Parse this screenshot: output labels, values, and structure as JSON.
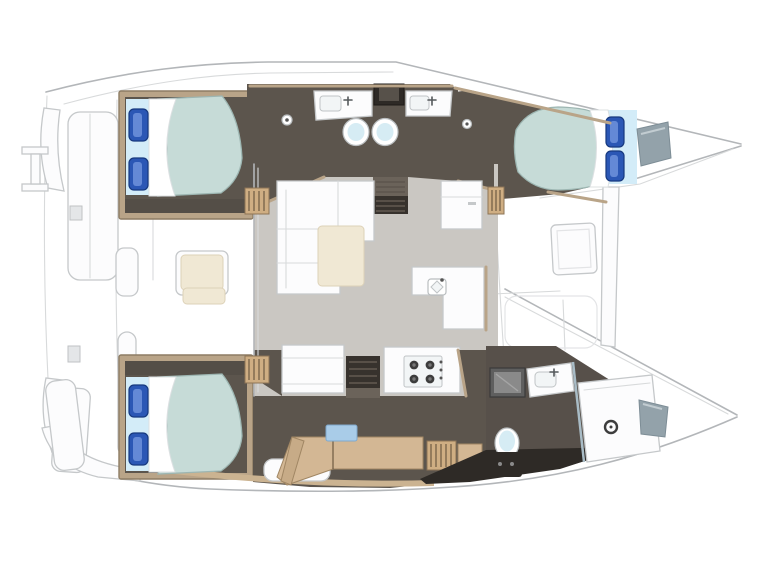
{
  "page": {
    "title": "Catamaran interior deck plan, top view, bows to the right",
    "background": "#ffffff"
  },
  "palette": {
    "outline": "#b3b6b9",
    "seam": "#d8dadb",
    "deck_white": "#fcfcfd",
    "cabin_floor": "#5c554d",
    "dark_wall": "#544e47",
    "shadow_dark": "#2e2a26",
    "trim_tan": "#b9a488",
    "wood": "#d3b794",
    "salon_floor": "#cac7c2",
    "mattress_teal": "#c6dbd7",
    "bed_band_blue": "#d3ecf8",
    "pillow_blue": "#2b57b5",
    "duvet_white": "#ffffff",
    "cushion_cream": "#f0e8d4",
    "window_gray": "#93a2aa",
    "appliance_gray": "#5f5f5f",
    "fixture_blue": "#d6ecf4",
    "item_blue": "#a9cce8"
  },
  "vessel": {
    "type": "sailing catamaran floor plan",
    "orientation": "bows to the right, stern platform to the left",
    "hulls": 2,
    "double_cabins": 3,
    "heads_compartments": 3
  },
  "regions": [
    {
      "id": "stern-platform",
      "label": "Stern platform, davits and boarding steps"
    },
    {
      "id": "cockpit",
      "label": "Aft cockpit bench seating"
    },
    {
      "id": "port-aft-cabin",
      "label": "Port aft double cabin"
    },
    {
      "id": "port-heads",
      "label": "Port heads: twin sink vanities and two toilets"
    },
    {
      "id": "port-forward-cabin",
      "label": "Port forward double cabin with hull window"
    },
    {
      "id": "salon",
      "label": "Salon with L-shaped sofa and chaise cushion"
    },
    {
      "id": "galley",
      "label": "Galley: L-counter with sink, 4-burner stove, fridge cabinet"
    },
    {
      "id": "starboard-aft-cabin",
      "label": "Starboard aft double cabin"
    },
    {
      "id": "starboard-desk",
      "label": "Starboard hull desk / dressing area"
    },
    {
      "id": "starboard-bathroom",
      "label": "Starboard forward bathroom with shower, vanity and toilet"
    },
    {
      "id": "foredeck",
      "label": "Foredeck, deck hatch and forward crossbeam"
    }
  ],
  "furniture_counts": {
    "double_beds": 3,
    "blue_pillows": 6,
    "toilets": 3,
    "sinks": 4,
    "stove_burners": 4,
    "showers": 1,
    "hull_windows": 2
  }
}
